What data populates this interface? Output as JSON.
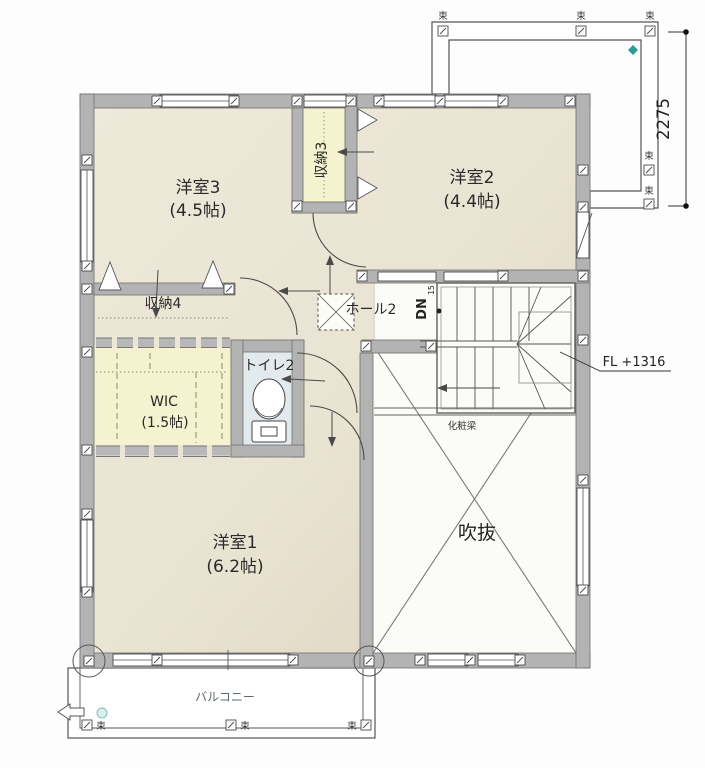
{
  "rooms": {
    "bedroom3": {
      "name": "洋室3",
      "area": "(4.5帖)"
    },
    "bedroom2": {
      "name": "洋室2",
      "area": "(4.4帖)"
    },
    "bedroom1": {
      "name": "洋室1",
      "area": "(6.2帖)"
    },
    "wic": {
      "name": "WIC",
      "area": "(1.5帖)"
    },
    "closet3": {
      "name": "収納3"
    },
    "closet4": {
      "name": "収納4"
    },
    "toilet": {
      "name": "トイレ2"
    },
    "hall": {
      "name": "ホール2"
    },
    "void": {
      "name": "吹抜"
    },
    "balcony": {
      "name": "バルコニー"
    }
  },
  "annotations": {
    "stair_down": "DN",
    "stair_count": "15",
    "floor_level": "FL +1316",
    "beam": "化粧梁",
    "post": "束",
    "dimension_right": "2275"
  },
  "colors": {
    "floor_beige": "#e9e4d5",
    "floor_beige_dark": "#dbd3bf",
    "closet_yellow": "#f4f2cf",
    "toilet_blue": "#e2eaee",
    "wall_gray": "#b3b3b3",
    "line_gray": "#555555",
    "accent_teal": "#2e9b94"
  }
}
